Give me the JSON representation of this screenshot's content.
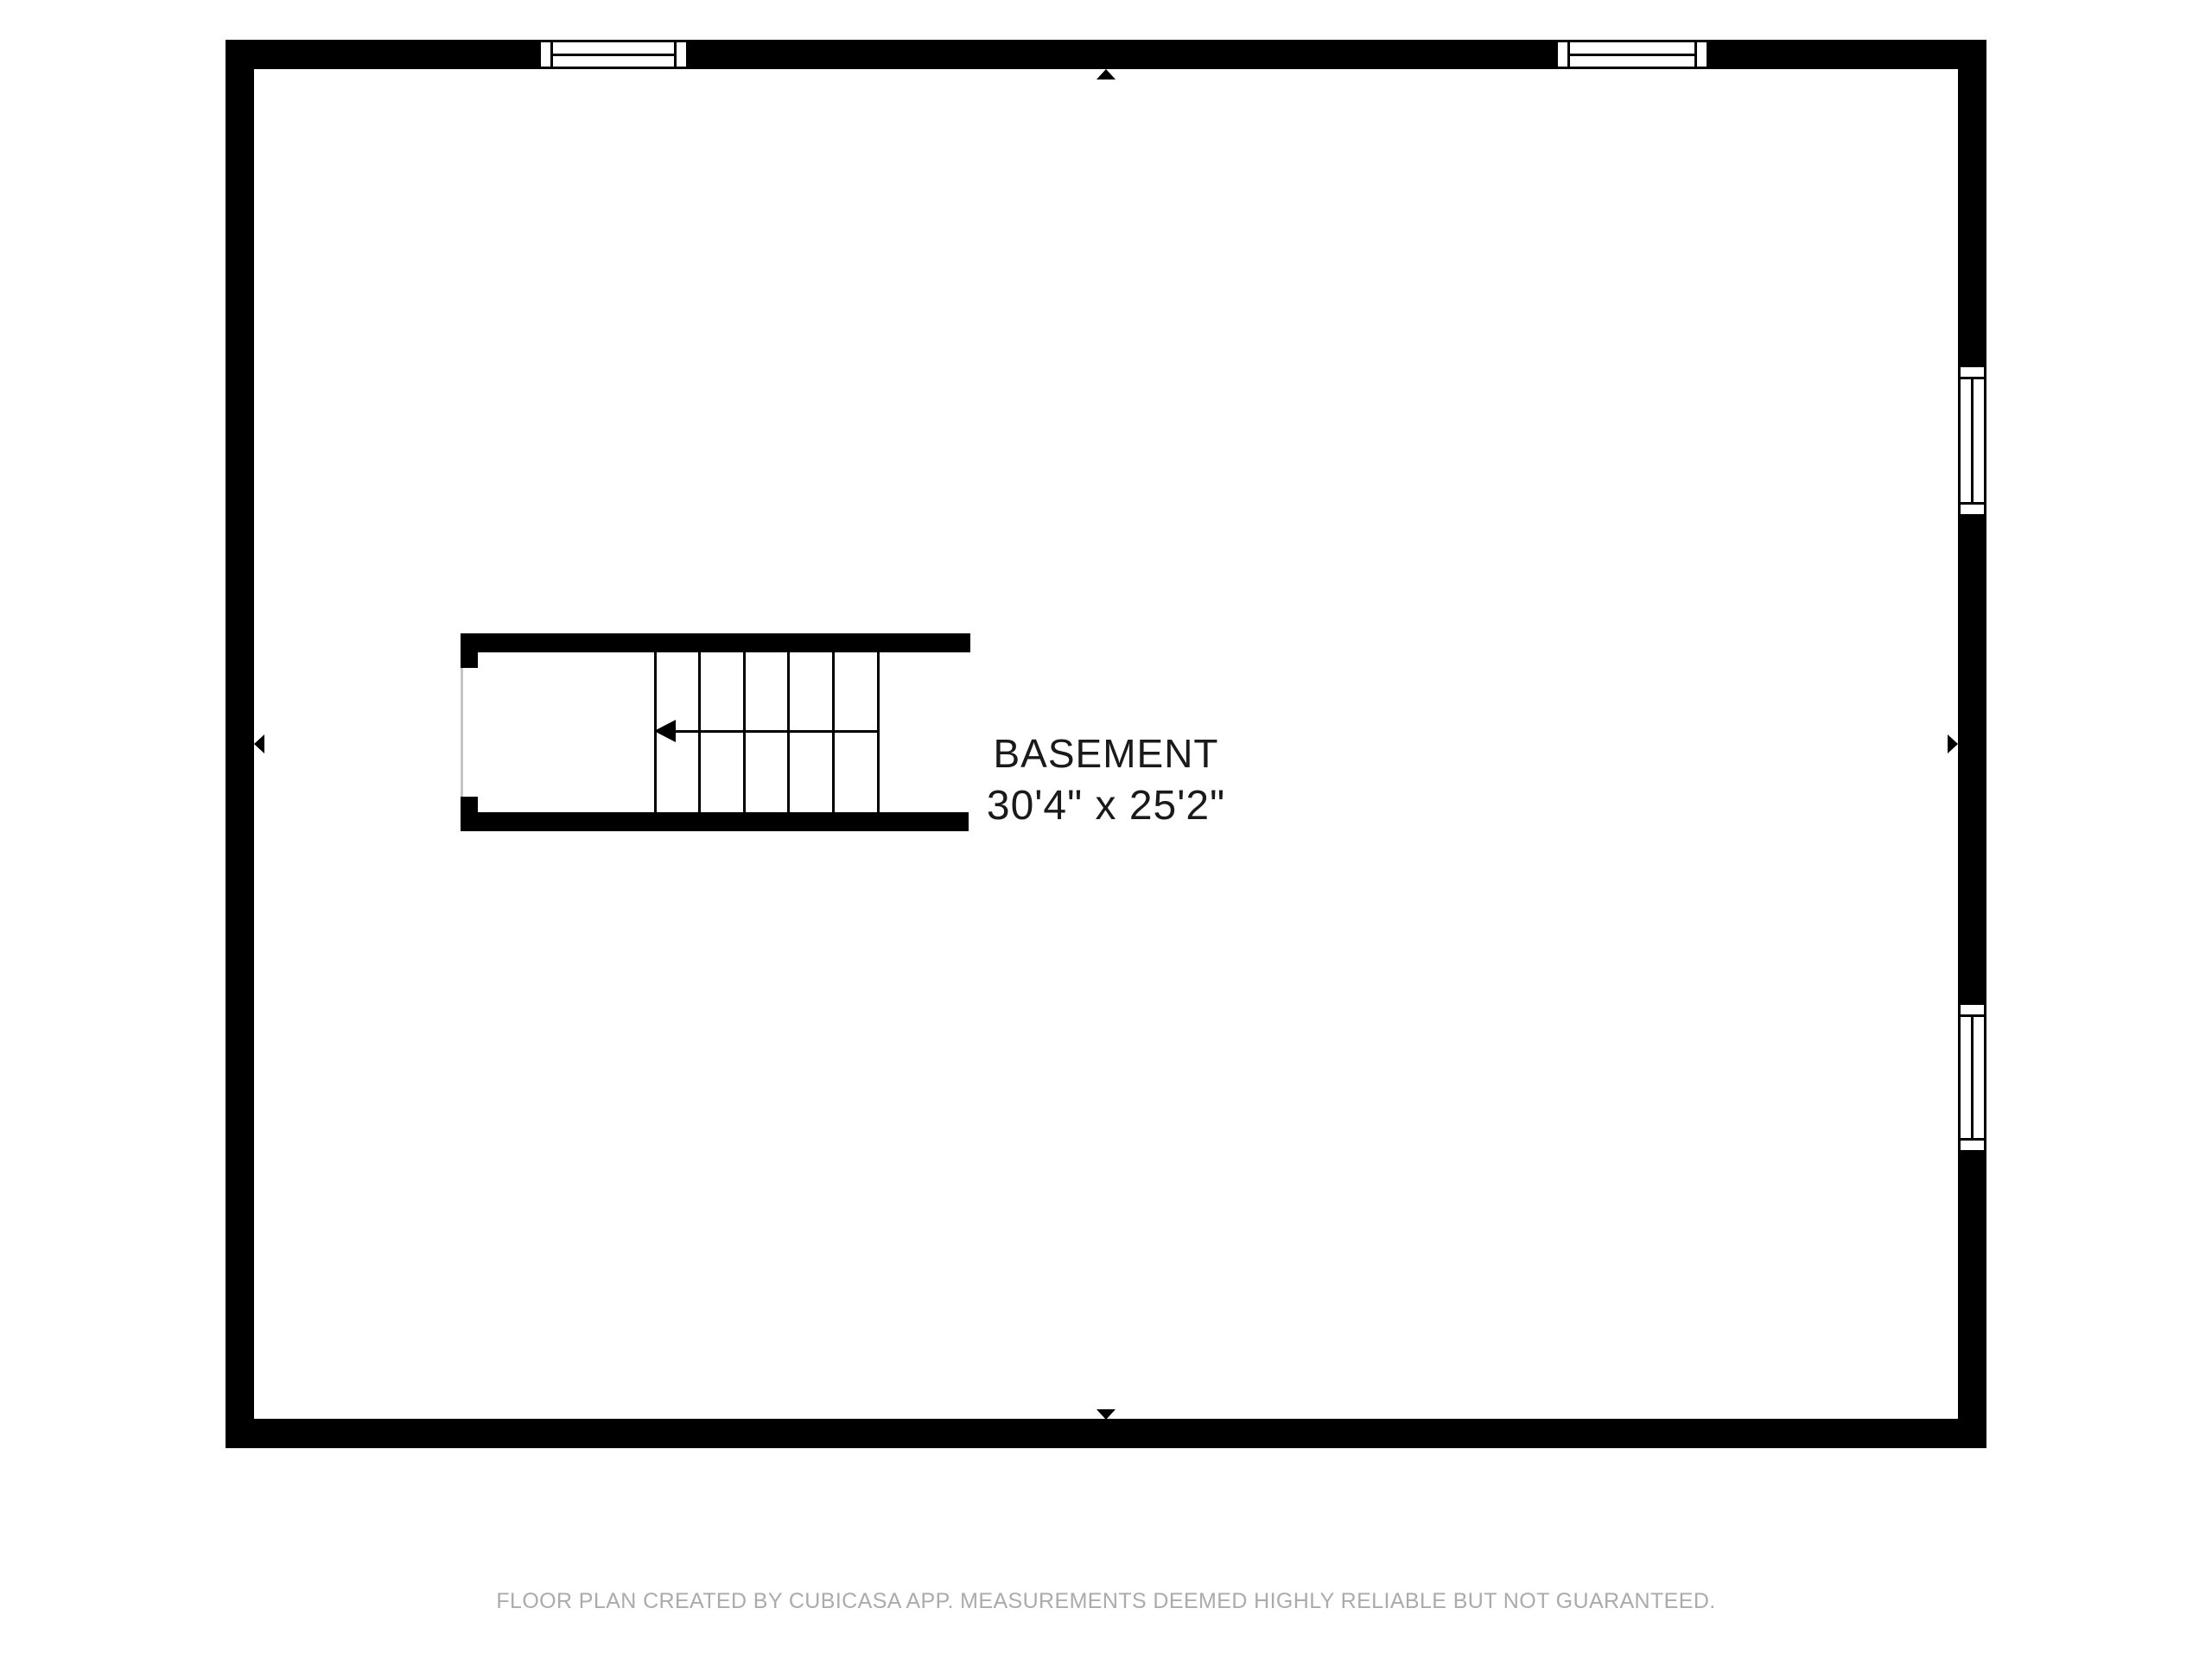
{
  "room": {
    "name": "BASEMENT",
    "dimensions": "30'4\" x 25'2\""
  },
  "footer": {
    "text": "FLOOR PLAN CREATED BY CUBICASA APP. MEASUREMENTS DEEMED HIGHLY RELIABLE BUT NOT GUARANTEED."
  },
  "icons": {
    "markers": [
      "triangle-up-icon",
      "triangle-down-icon",
      "triangle-left-icon",
      "triangle-right-icon"
    ],
    "stair_direction": "arrow-left-icon"
  },
  "colors": {
    "wall": "#000000",
    "background": "#ffffff",
    "stair_open_edge": "#c4c4c4",
    "label_text": "#1a1a1a",
    "footer_text": "#ababab"
  }
}
